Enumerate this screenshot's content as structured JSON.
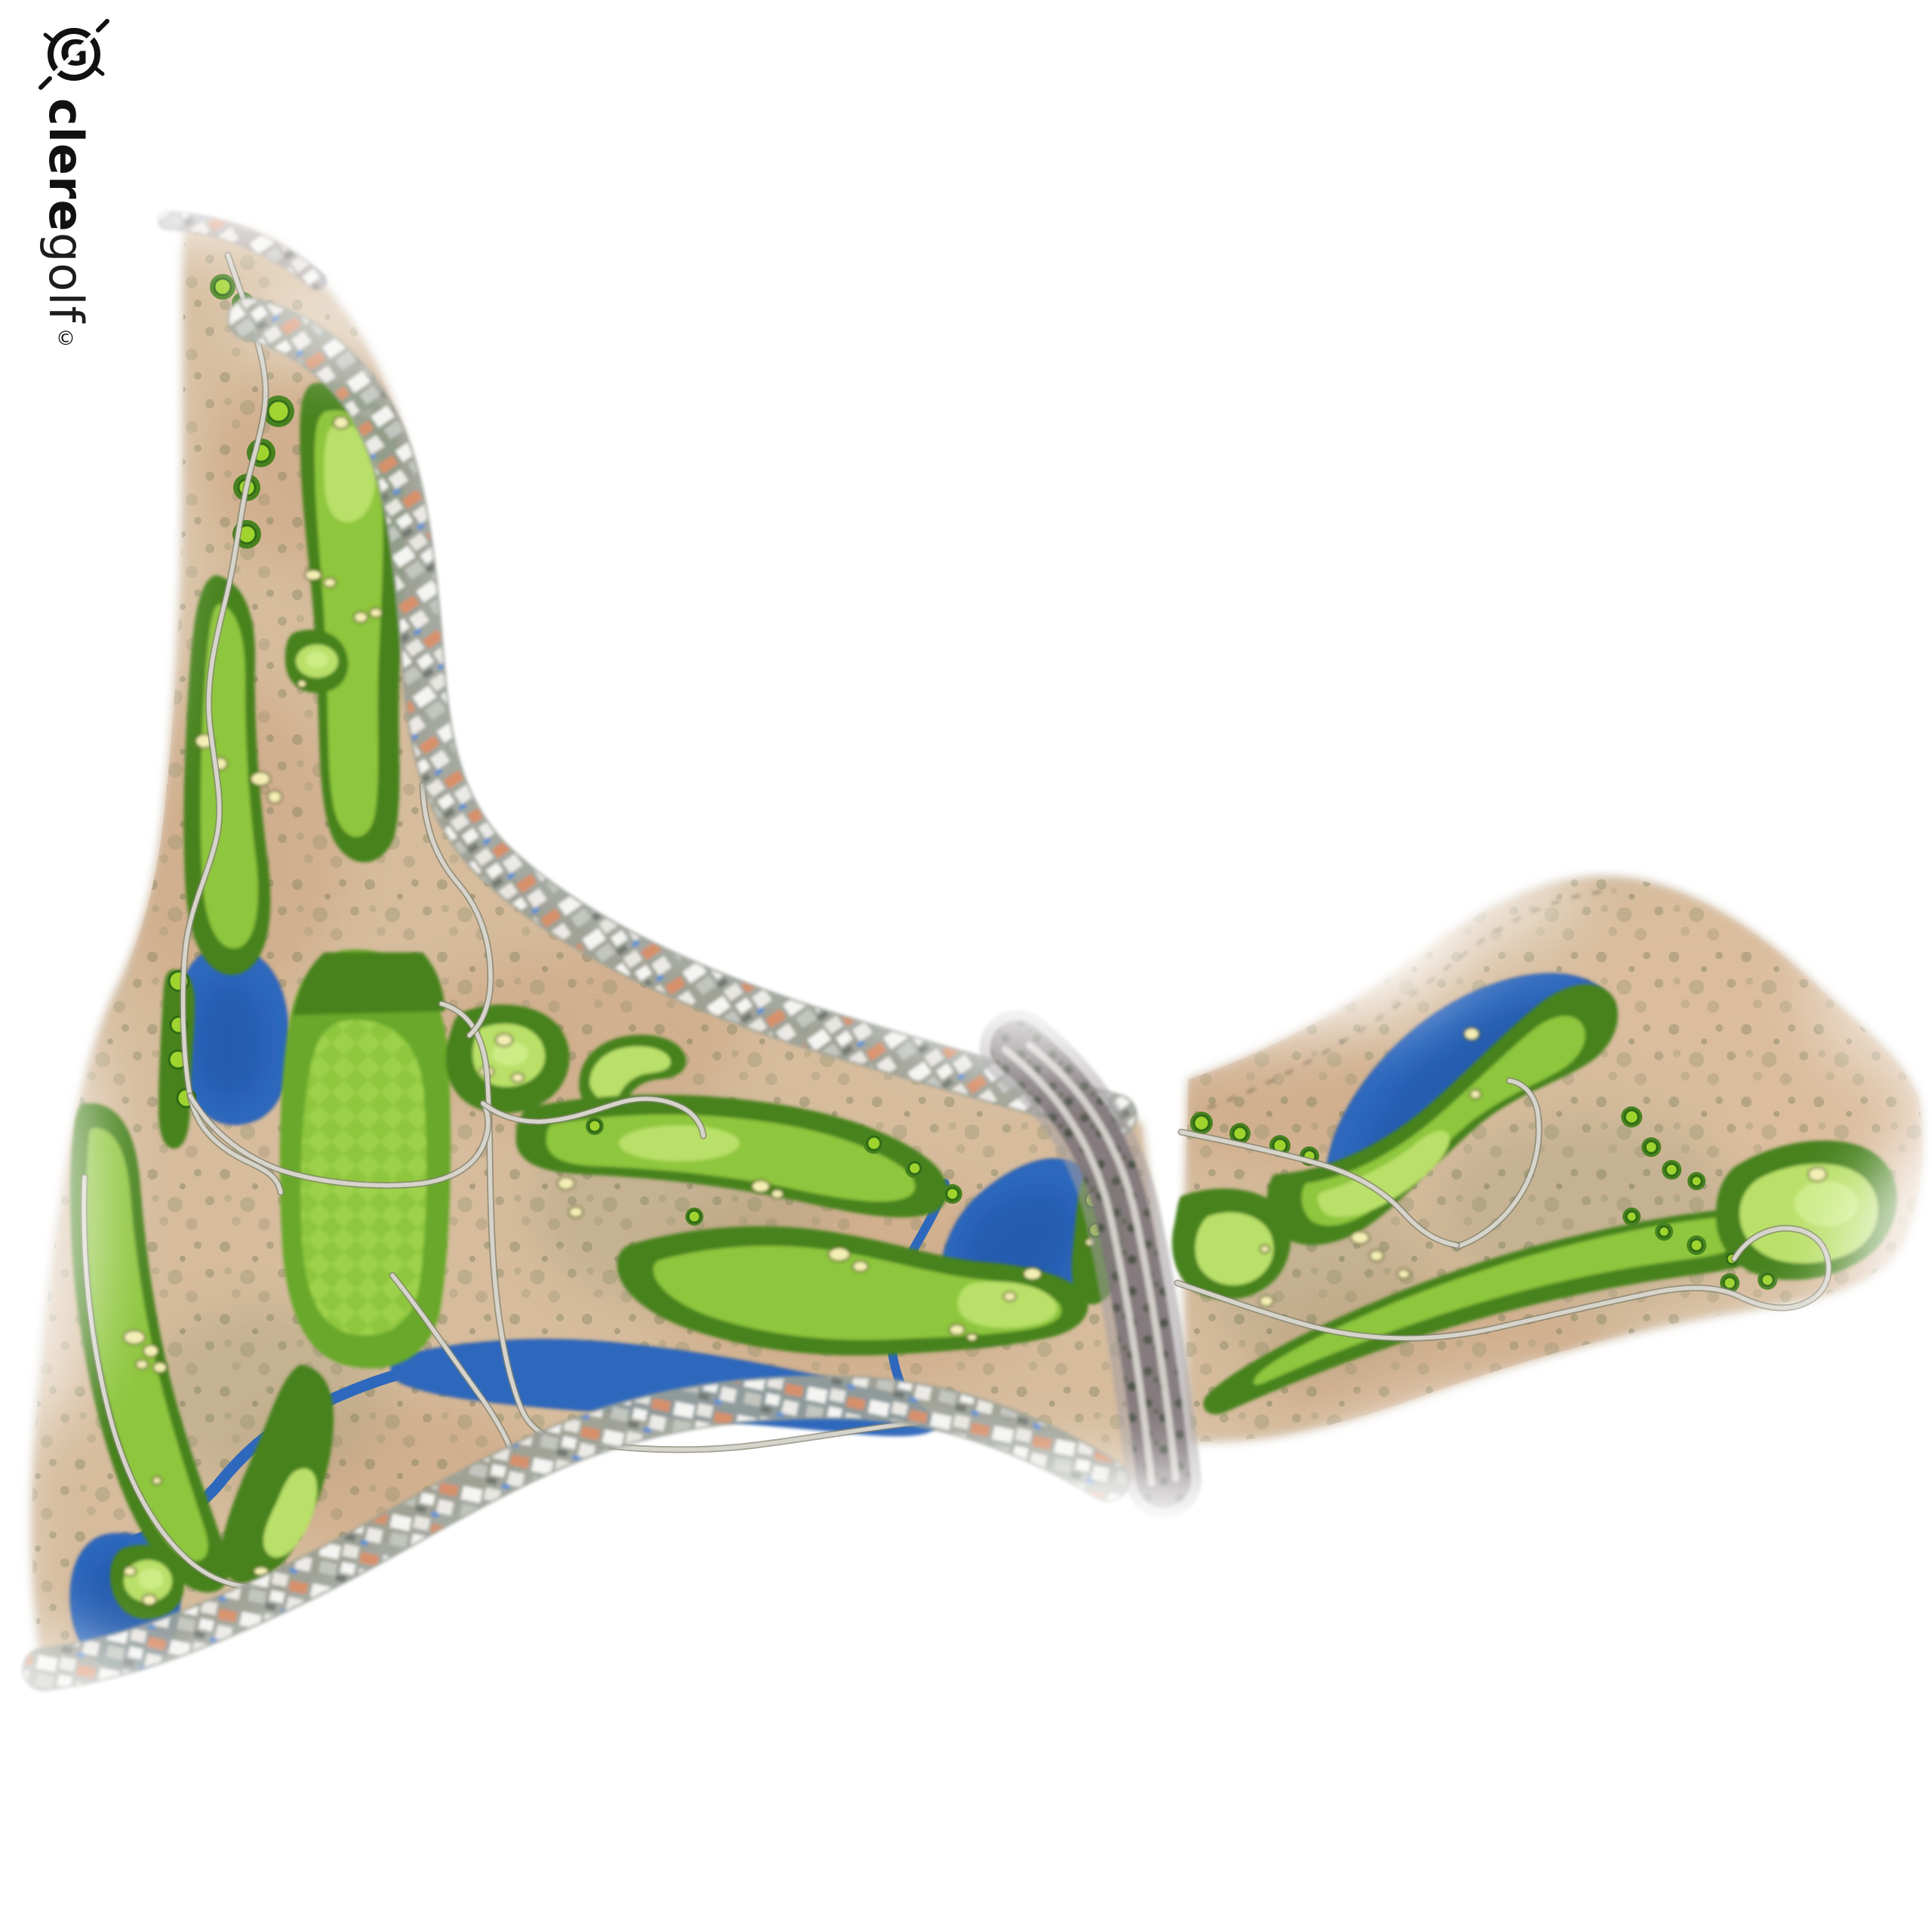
{
  "logo": {
    "brand_primary": "clere",
    "brand_secondary": "golf",
    "trademark": "©",
    "mark_letter": "G"
  },
  "map": {
    "type": "golf-course-masterplan",
    "style": "watercolor-aerial-plan",
    "features": [
      "desert-scrub-parcels",
      "fairways",
      "putting-greens",
      "tee-boxes",
      "bunkers",
      "driving-range",
      "lakes",
      "creek",
      "cart-paths",
      "residential-roof-strips",
      "tree-lined-avenue",
      "dashed-property-boundary"
    ]
  },
  "palette": {
    "paper": "#ffffff",
    "ink": "#111111",
    "desert": "#d6bc9d",
    "desert_edge": "#8b7b60",
    "desert_tint": "#c89d78",
    "desert_pink": "#e3bfa0",
    "scrub": "#6b7350",
    "rough_green": "#47821f",
    "fairway": "#69a82c",
    "fairway_light": "#8ec63e",
    "green_light": "#b9e068",
    "green_bright": "#ccec86",
    "range_light": "#9ccf4a",
    "tee": "#9fd42e",
    "tee_ring": "#2f6b16",
    "bunker": "#f4efb4",
    "bunker_edge": "#55551f",
    "water": "#2e68bd",
    "water_dark": "#1d4fa0",
    "cart_path": "#d6d4cb",
    "cart_path_edge": "#82826f",
    "road": "#a39da0",
    "road_dark": "#7e767a",
    "road_lane": "#d8d5d0",
    "strip_shadow": "#9aa096",
    "building_white": "#f4f4f2",
    "building_gray": "#c2c6bf",
    "building_orange": "#d8906a",
    "building_dark": "#707671",
    "pool": "#5b8fd4",
    "tree": "#4a5244",
    "boundary": "#7a6a52"
  }
}
